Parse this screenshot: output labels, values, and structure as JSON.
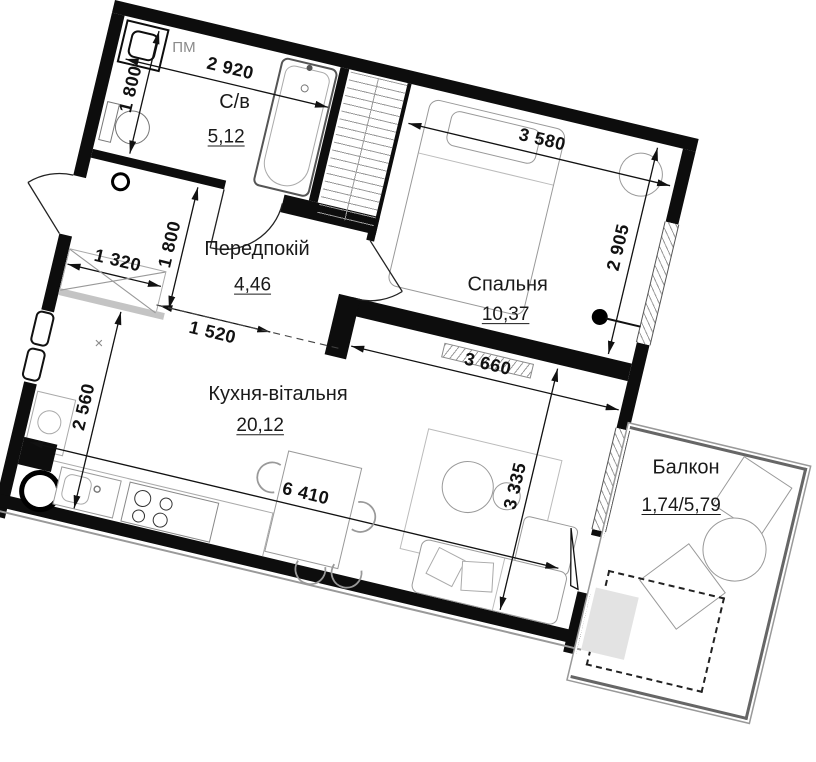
{
  "plan": {
    "title": "apartment-floor-plan",
    "rooms": {
      "bathroom": {
        "name": "С/в",
        "area": "5,12"
      },
      "hallway": {
        "name": "Передпокій",
        "area": "4,46"
      },
      "bedroom": {
        "name": "Спальня",
        "area": "10,37"
      },
      "kitchen_living": {
        "name": "Кухня-вітальня",
        "area": "20,12"
      },
      "balcony": {
        "name": "Балкон",
        "area": "1,74/5,79"
      }
    },
    "labels": {
      "washing_machine": "ПМ",
      "shaft_marker": "×"
    },
    "dimensions_mm": {
      "bathroom_width": "2 920",
      "bathroom_depth": "1 800",
      "bedroom_width": "3 580",
      "bedroom_depth": "2 905",
      "hallway_depth": "1 800",
      "hall_closet_width": "1 320",
      "passage_width": "1 520",
      "partition_length": "3 660",
      "kitchen_depth_left": "2 560",
      "kitchen_length": "6 410",
      "kitchen_depth_right": "3 335"
    },
    "colors": {
      "wall": "#0d0d0d",
      "furniture_outline": "#999999",
      "dimension": "#111111"
    }
  }
}
